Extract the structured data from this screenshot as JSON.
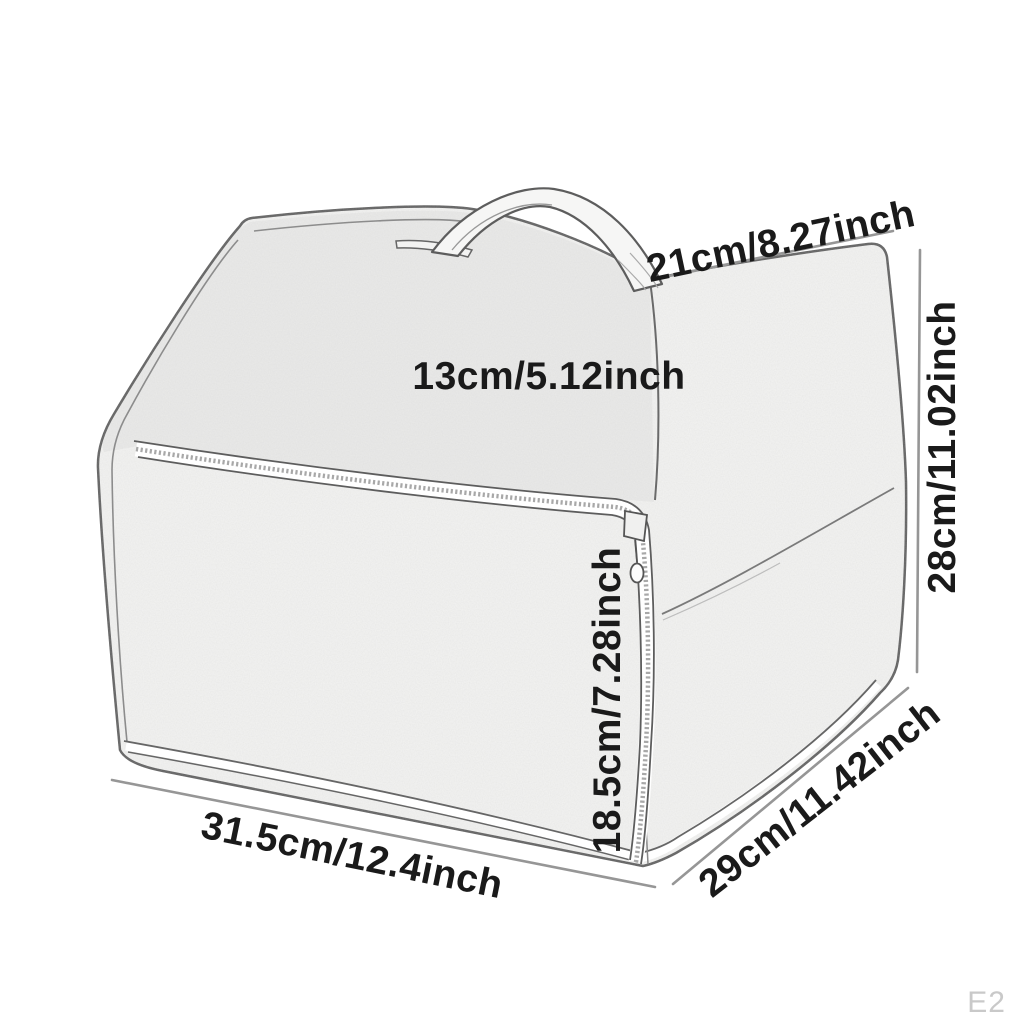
{
  "page": {
    "background_color": "#ffffff",
    "watermark": "E2"
  },
  "diagram": {
    "subject": "fabric-storage-organizer-sketch",
    "dimension_labels": {
      "top_edge": "21cm/8.27inch",
      "top_panel": "13cm/5.12inch",
      "overall_height": "28cm/11.02inch",
      "front_panel_height": "18.5cm/7.28inch",
      "bottom_width": "31.5cm/12.4inch",
      "side_depth": "29cm/11.42inch"
    },
    "colors": {
      "label_text": "#1a1a1a",
      "dimension_line": "#969696",
      "sketch_outline": "#5e5e5e",
      "fabric_fill": "#f4f4f3",
      "watermark_text": "#c9c9c9"
    }
  }
}
